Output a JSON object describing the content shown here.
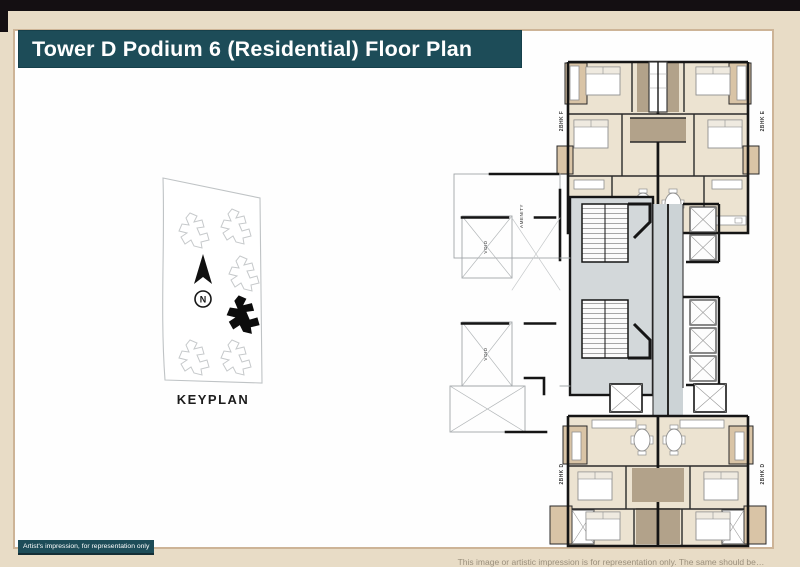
{
  "header": {
    "title": "Tower D Podium 6 (Residential) Floor Plan"
  },
  "keyplan": {
    "caption": "KEYPLAN",
    "north": "N"
  },
  "plan": {
    "units": {
      "top_left": "2BHK F",
      "top_right": "2BHK E",
      "bottom_left": "2BHK D",
      "bottom_right": "2BHK D"
    },
    "areas": {
      "amenity": "AMENITY",
      "void_upper": "VOID",
      "void_lower": "VOID"
    }
  },
  "footer": {
    "artist_note": "Artist's impression, for representation only",
    "clipped_disclaimer": "This image or artistic impression is for representation only. The same should be…"
  },
  "colors": {
    "banner_teal": "#1d4c58",
    "page_cream": "#e8dcc6",
    "card_border": "#cdb497",
    "wall_black": "#151515",
    "room_beige": "#ece3d1",
    "bath_brown": "#b2a28a",
    "balcony_tan": "#d9c4a6",
    "corridor_gray": "#ccd3d6"
  }
}
